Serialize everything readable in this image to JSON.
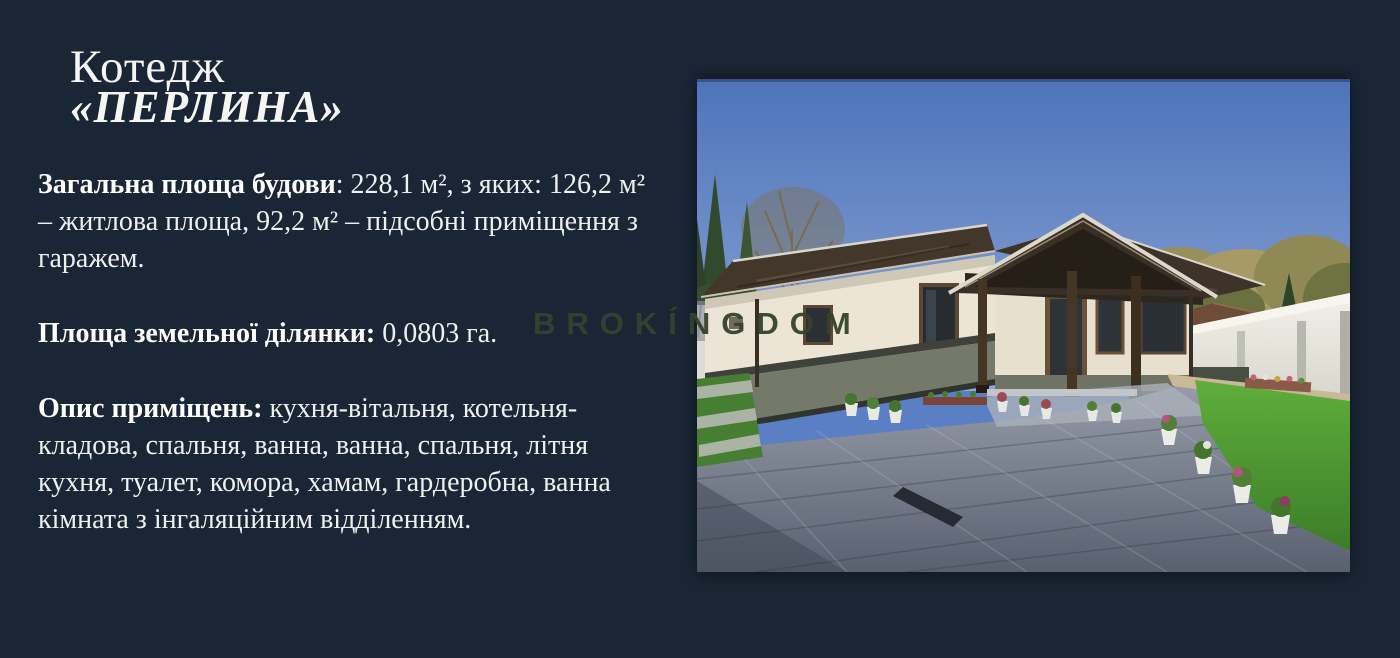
{
  "slide": {
    "title": {
      "line1": "Котедж",
      "line2": "«ПЕРЛИНА»"
    },
    "paragraphs": {
      "total_area": {
        "label": "Загальна площа будови",
        "text": ": 228,1 м², з яких: 126,2 м² – житлова площа, 92,2 м² – підсобні приміщення з гаражем."
      },
      "land_area": {
        "label": "Площа земельної ділянки:",
        "text": " 0,0803 га."
      },
      "rooms": {
        "label": "Опис приміщень:",
        "text": " кухня-вітальня, котельня-кладова, спальня, ванна, ванна, спальня, літня кухня, туалет, комора, хамам, гардеробна, ванна кімната з інгаляційним відділенням."
      }
    },
    "watermark": "BROKÍNGDOM",
    "photo": {
      "description": "One-storey cottage with dark hipped roofs, porch with carved frieze, white fence, green lawns and grey paved courtyard under a clear blue sky"
    },
    "colors": {
      "background": "#1a2635",
      "text": "#edf0ee",
      "watermark": "#36422c",
      "sky": "#5a7fc4"
    }
  }
}
